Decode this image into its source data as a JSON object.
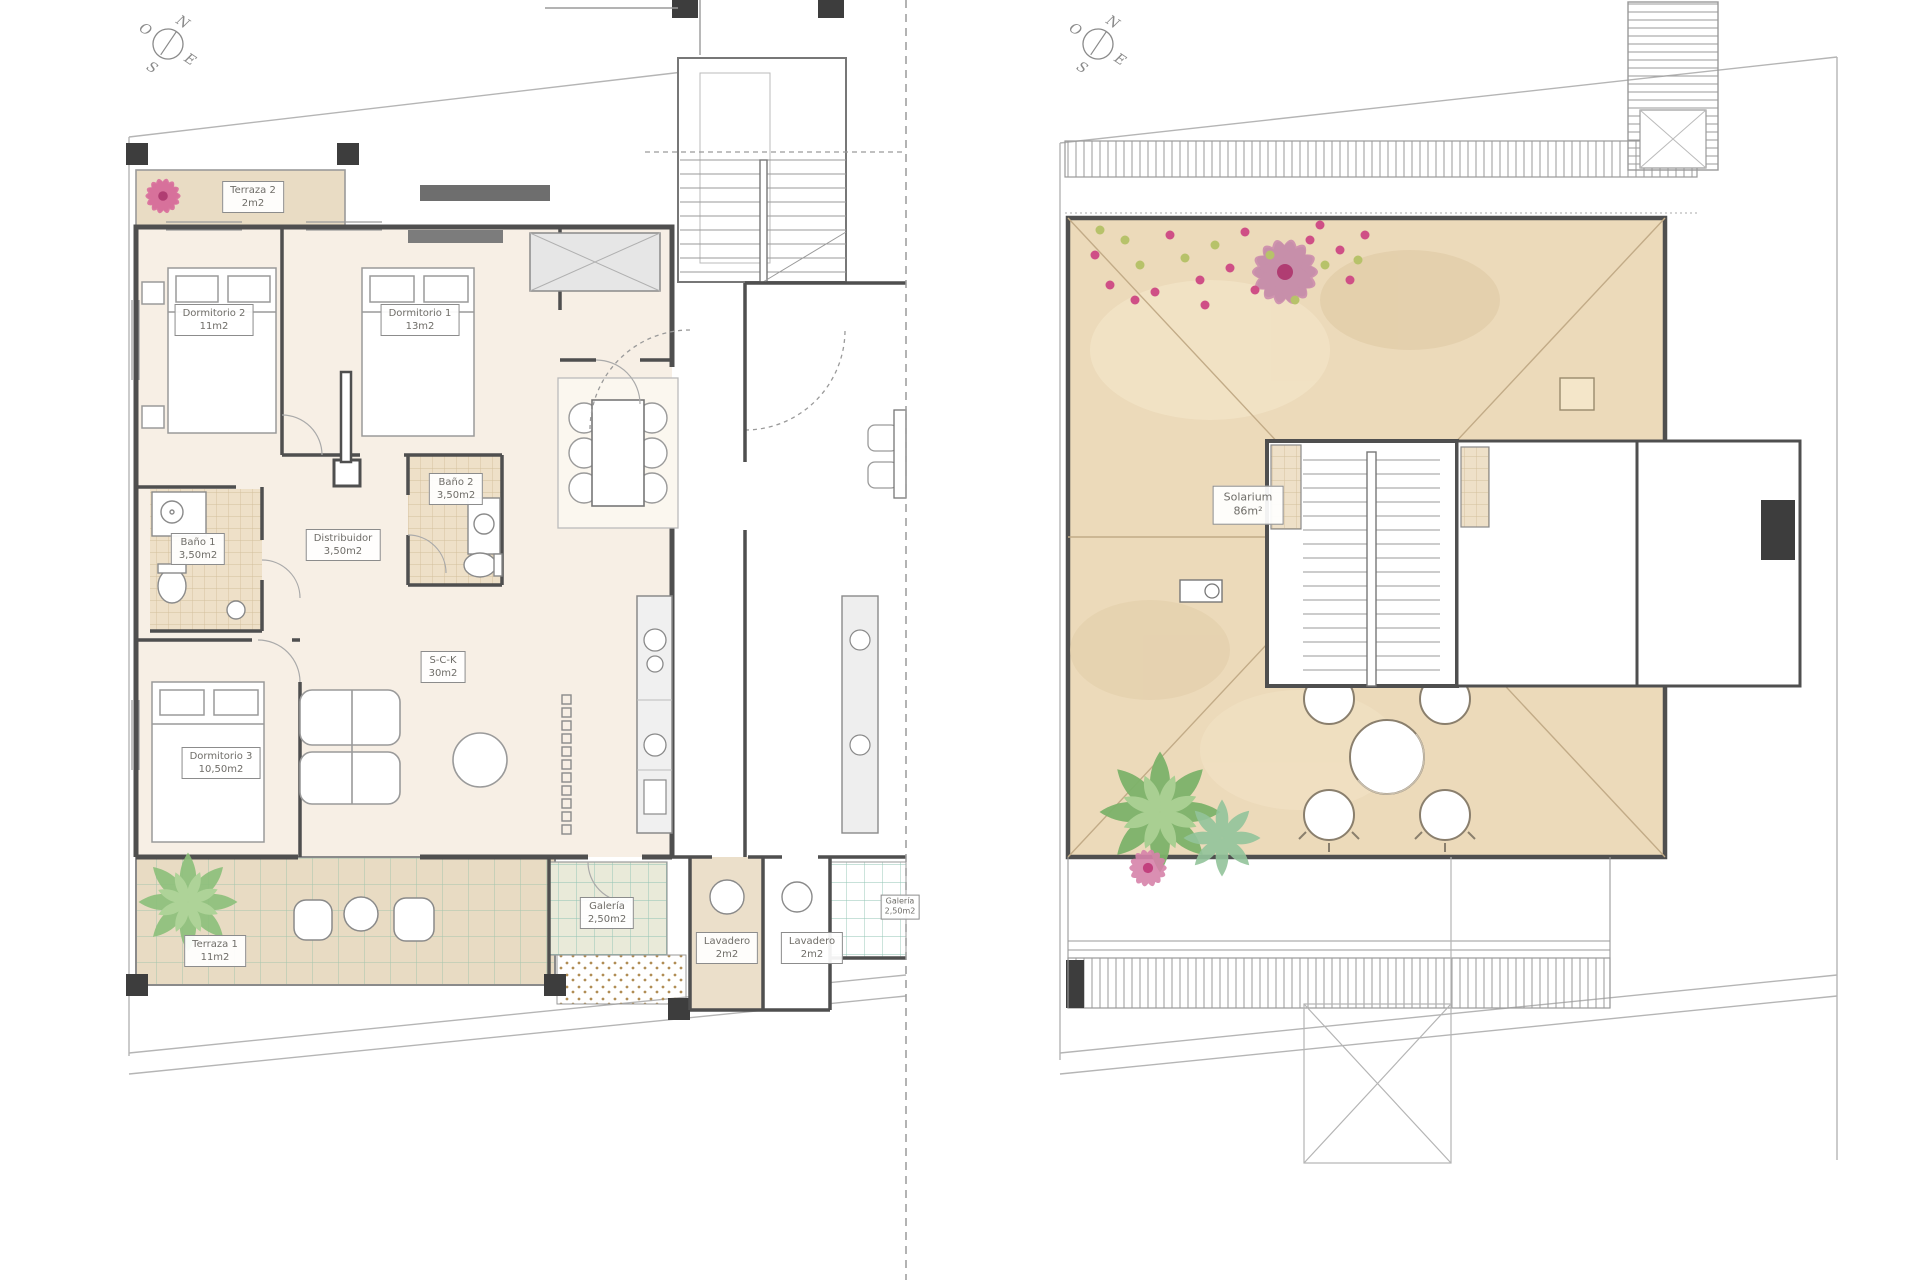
{
  "compass": {
    "n": "N",
    "e": "E",
    "s": "S",
    "o": "O"
  },
  "colors": {
    "wall": "#4f4f4f",
    "room_fill": "#f7efe5",
    "terrace_fill": "#e8dbc3",
    "solarium_fill": "#ecdaba",
    "flower_pink": "#d1477e",
    "plant_green": "#7db36a"
  },
  "plans": {
    "left": {
      "rooms": [
        {
          "name": "Terraza 2",
          "area": "2m2"
        },
        {
          "name": "Dormitorio 2",
          "area": "11m2"
        },
        {
          "name": "Dormitorio 1",
          "area": "13m2"
        },
        {
          "name": "Baño 2",
          "area": "3,50m2"
        },
        {
          "name": "Baño 1",
          "area": "3,50m2"
        },
        {
          "name": "Distribuidor",
          "area": "3,50m2"
        },
        {
          "name": "S-C-K",
          "area": "30m2"
        },
        {
          "name": "Dormitorio 3",
          "area": "10,50m2"
        },
        {
          "name": "Terraza 1",
          "area": "11m2"
        },
        {
          "name": "Galería",
          "area": "2,50m2"
        },
        {
          "name": "Lavadero",
          "area": "2m2"
        },
        {
          "name": "Lavadero",
          "area": "2m2"
        },
        {
          "name": "Galería",
          "area": "2,50m2"
        }
      ]
    },
    "right": {
      "rooms": [
        {
          "name": "Solarium",
          "area": "86m²"
        }
      ]
    }
  }
}
